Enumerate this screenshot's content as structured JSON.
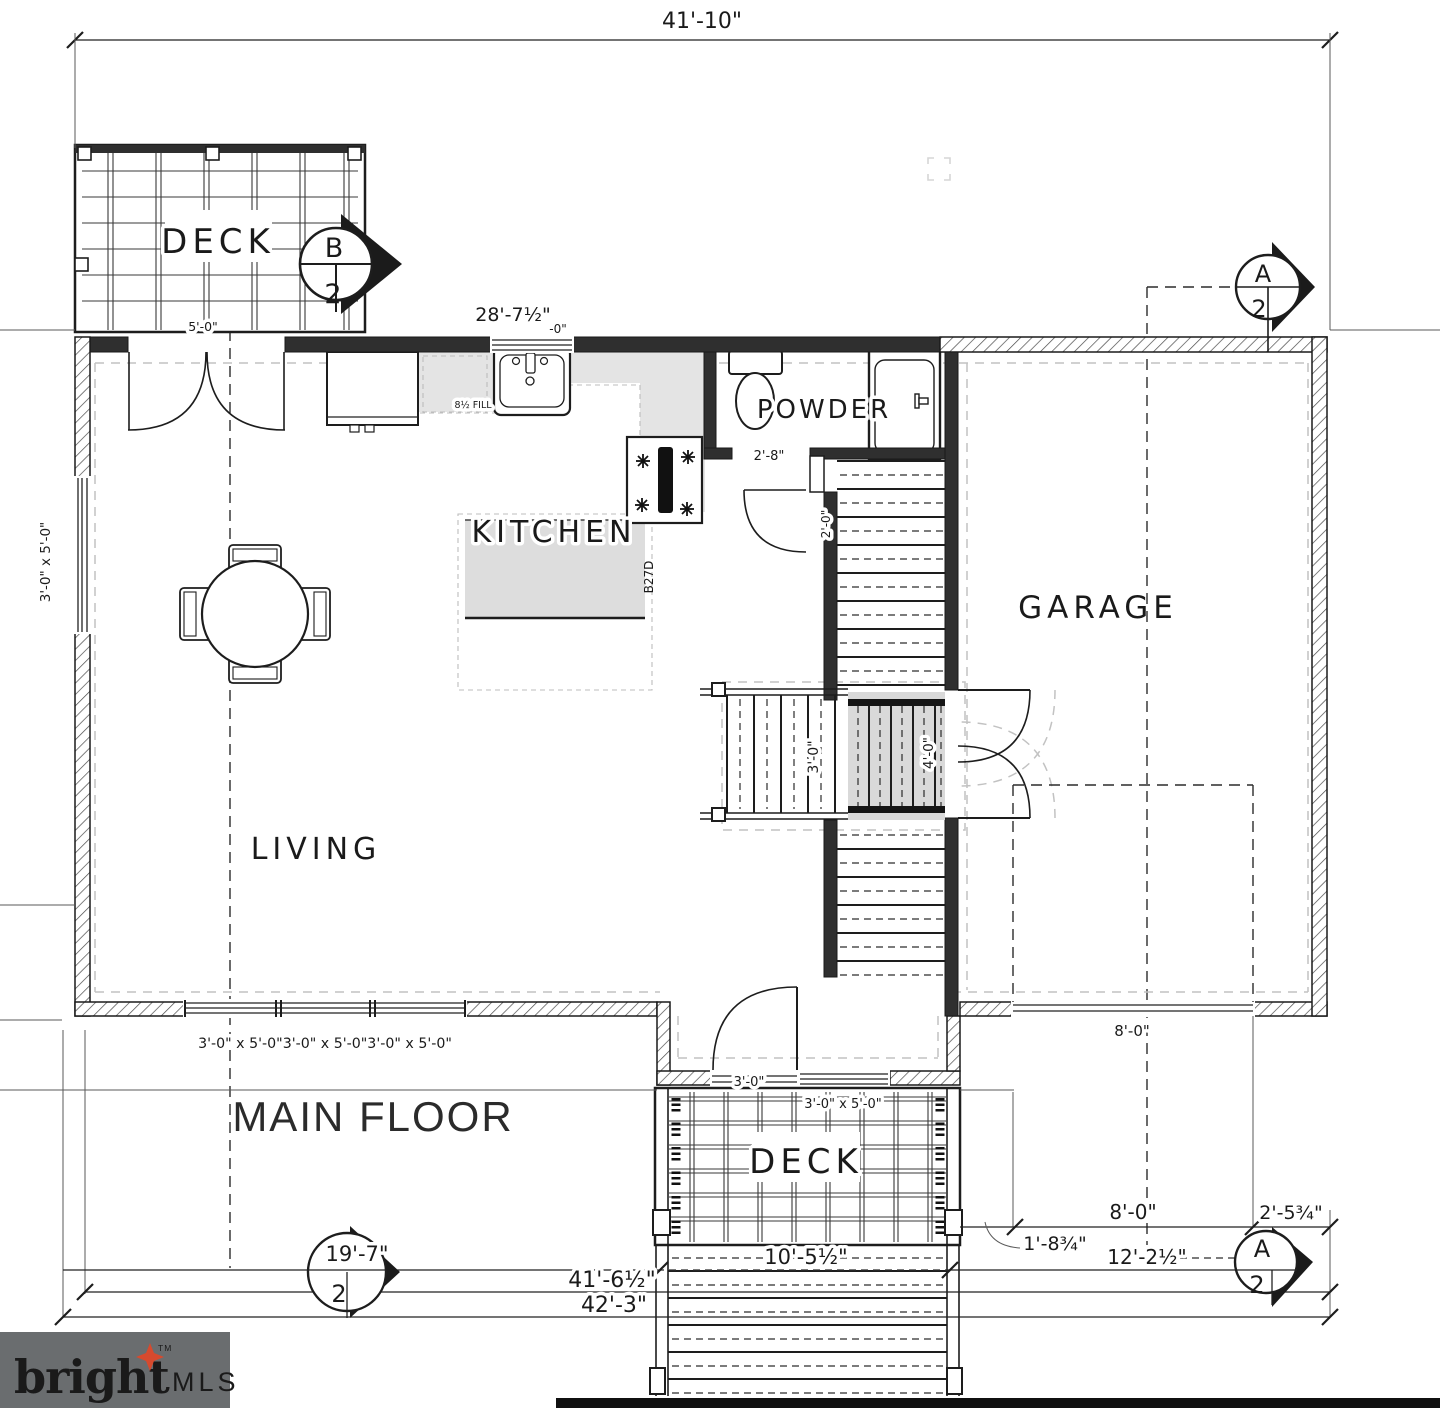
{
  "title": "MAIN FLOOR",
  "rooms": {
    "deck_top": "DECK",
    "deck_bottom": "DECK",
    "kitchen": "KITCHEN",
    "powder": "POWDER",
    "garage": "GARAGE",
    "living": "LIVING"
  },
  "markers": {
    "b_top_letter": "B",
    "b_top_num": "2",
    "a_top_letter": "A",
    "a_top_num": "2",
    "a_bottom_letter": "A",
    "a_bottom_num": "2",
    "b_bottom_num": "2"
  },
  "dims": {
    "overall": "41'-10\"",
    "kitchen_run": "28'-7½\"",
    "kitchen_run_suffix": "-0\"",
    "deck_top_width": "5'-0\"",
    "left_window": "3'-0\" x 5'-0\"",
    "powder_door": "2'-8\"",
    "stair_door": "2'-0\"",
    "stair_lower_width": "3'-0\"",
    "stair_upper_width": "4'-0\"",
    "bottom_windows": "3'-0\" x 5'-0\"3'-0\" x 5'-0\"3'-0\" x 5'-0\"",
    "garage_door": "8'-0\"",
    "garage_door_line": "8'-0\"",
    "entry_door": "3'-0\"",
    "entry_window": "3'-0\" x 5'-0\"",
    "deck_offset": "1'-8¾\"",
    "garage_width": "12'-2½\"",
    "right_offset": "2'-5¾\"",
    "deck_bottom_width": "10'-5½\"",
    "left_span": "19'-7\"",
    "span_41": "41'-6½\"",
    "span_42": "42'-3\""
  },
  "annotations": {
    "cabinet_code": "B27D",
    "filler": "8½ FILL"
  },
  "logo": {
    "brand": "bright",
    "tm": "TM",
    "suffix": "MLS"
  }
}
